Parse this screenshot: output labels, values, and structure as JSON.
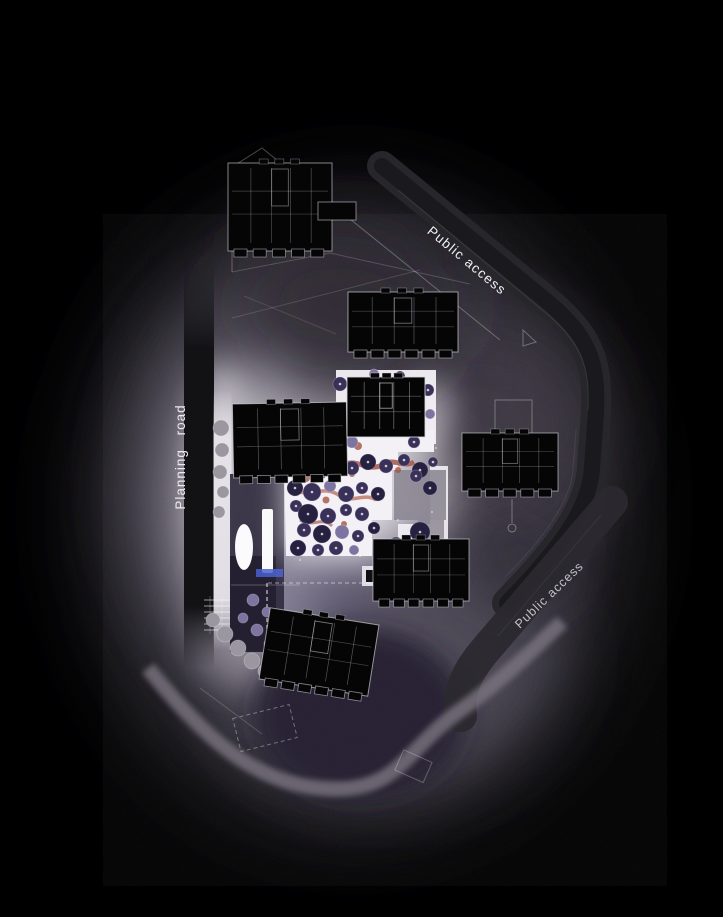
{
  "labels": {
    "public_access_top": "Public access",
    "planning_road": "Planning  road",
    "public_access_bottom": "Public access"
  },
  "colors": {
    "background": "#000000",
    "plaza": "#f3f1f6",
    "plaza_shadow": "#8d8894",
    "ground_glow": "#6d6876",
    "road_dark": "#27262b",
    "road_light": "#7a7580",
    "sidewalk": "#e7e5ea",
    "building_fill": "#050506",
    "building_line": "#d9d9df",
    "accent_path": "#a5553f",
    "label_text": "#f2f1f5",
    "chip_blue": "#4a5fd0",
    "dark_soil": "#221d2e"
  },
  "tree_palette": {
    "P": {
      "fill": "#393157",
      "stroke": "rgba(205,200,228,0.35)",
      "dot": true
    },
    "D": {
      "fill": "#272140",
      "stroke": "rgba(190,185,215,0.30)",
      "dot": true
    },
    "L": {
      "fill": "#7d74a1",
      "stroke": "rgba(255,255,255,0.30)",
      "dot": false
    },
    "G": {
      "fill": "#9a97a0",
      "stroke": "rgba(255,255,255,0.28)",
      "dot": false
    }
  },
  "trees": [
    [
      303,
      464,
      7,
      "P"
    ],
    [
      318,
      470,
      10,
      "D"
    ],
    [
      336,
      460,
      8,
      "P"
    ],
    [
      352,
      468,
      7,
      "P"
    ],
    [
      368,
      462,
      8,
      "D"
    ],
    [
      386,
      466,
      7,
      "P"
    ],
    [
      404,
      460,
      6,
      "P"
    ],
    [
      420,
      470,
      8,
      "D"
    ],
    [
      433,
      462,
      5,
      "P"
    ],
    [
      295,
      488,
      8,
      "D"
    ],
    [
      312,
      492,
      9,
      "P"
    ],
    [
      330,
      486,
      6,
      "L"
    ],
    [
      346,
      494,
      8,
      "P"
    ],
    [
      362,
      488,
      6,
      "P"
    ],
    [
      378,
      494,
      7,
      "D"
    ],
    [
      296,
      506,
      6,
      "P"
    ],
    [
      308,
      514,
      10,
      "D"
    ],
    [
      328,
      516,
      8,
      "P"
    ],
    [
      346,
      510,
      6,
      "P"
    ],
    [
      362,
      514,
      7,
      "P"
    ],
    [
      304,
      530,
      7,
      "P"
    ],
    [
      322,
      534,
      9,
      "D"
    ],
    [
      342,
      532,
      7,
      "L"
    ],
    [
      358,
      536,
      6,
      "P"
    ],
    [
      374,
      528,
      6,
      "D"
    ],
    [
      298,
      548,
      8,
      "D"
    ],
    [
      318,
      550,
      6,
      "P"
    ],
    [
      336,
      548,
      7,
      "P"
    ],
    [
      354,
      550,
      5,
      "L"
    ],
    [
      396,
      544,
      7,
      "P"
    ],
    [
      420,
      532,
      10,
      "D"
    ],
    [
      428,
      548,
      6,
      "P"
    ],
    [
      416,
      476,
      6,
      "P"
    ],
    [
      430,
      488,
      7,
      "D"
    ],
    [
      340,
      384,
      7,
      "P"
    ],
    [
      428,
      390,
      6,
      "P"
    ],
    [
      338,
      412,
      5,
      "D"
    ],
    [
      430,
      414,
      5,
      "L"
    ],
    [
      352,
      442,
      6,
      "L"
    ],
    [
      414,
      442,
      6,
      "P"
    ],
    [
      374,
      374,
      5,
      "L"
    ],
    [
      400,
      376,
      5,
      "P"
    ],
    [
      249,
      428,
      6,
      "P"
    ],
    [
      252,
      450,
      6,
      "D"
    ],
    [
      249,
      472,
      5,
      "P"
    ],
    [
      221,
      428,
      8,
      "G"
    ],
    [
      222,
      450,
      7,
      "G"
    ],
    [
      220,
      472,
      7,
      "G"
    ],
    [
      223,
      492,
      6,
      "G"
    ],
    [
      219,
      512,
      6,
      "G"
    ],
    [
      213,
      620,
      7,
      "G"
    ],
    [
      225,
      634,
      8,
      "G"
    ],
    [
      238,
      648,
      8,
      "G"
    ],
    [
      252,
      661,
      8,
      "G"
    ],
    [
      265,
      671,
      7,
      "G"
    ],
    [
      243,
      618,
      5,
      "L"
    ],
    [
      257,
      630,
      6,
      "L"
    ],
    [
      270,
      644,
      6,
      "L"
    ],
    [
      281,
      657,
      5,
      "L"
    ],
    [
      253,
      600,
      6,
      "L"
    ],
    [
      267,
      612,
      5,
      "L"
    ]
  ],
  "buildings": [
    {
      "name": "building-north",
      "x": 228,
      "y": 163,
      "w": 104,
      "h": 88,
      "rot": 0,
      "bal": 5,
      "lo": 0.5
    },
    {
      "name": "building-north-annex",
      "x": 318,
      "y": 202,
      "w": 38,
      "h": 18,
      "rot": 0,
      "bal": 0,
      "lo": 0.45
    },
    {
      "name": "building-upper-mid",
      "x": 348,
      "y": 292,
      "w": 110,
      "h": 60,
      "rot": 0,
      "bal": 6,
      "lo": 0.55
    },
    {
      "name": "building-west",
      "x": 233,
      "y": 403,
      "w": 114,
      "h": 74,
      "rot": -1,
      "bal": 6,
      "lo": 0.55
    },
    {
      "name": "building-center-small",
      "x": 347,
      "y": 377,
      "w": 78,
      "h": 60,
      "rot": 0,
      "bal": 0,
      "lo": 0.75
    },
    {
      "name": "building-east",
      "x": 462,
      "y": 433,
      "w": 96,
      "h": 58,
      "rot": 0,
      "bal": 5,
      "lo": 0.5,
      "stem": true
    },
    {
      "name": "building-south-mid",
      "x": 373,
      "y": 539,
      "w": 96,
      "h": 62,
      "rot": 0,
      "bal": 6,
      "lo": 0.5
    },
    {
      "name": "building-south",
      "x": 264,
      "y": 616,
      "w": 110,
      "h": 72,
      "rot": 9,
      "bal": 6,
      "lo": 0.55
    }
  ]
}
